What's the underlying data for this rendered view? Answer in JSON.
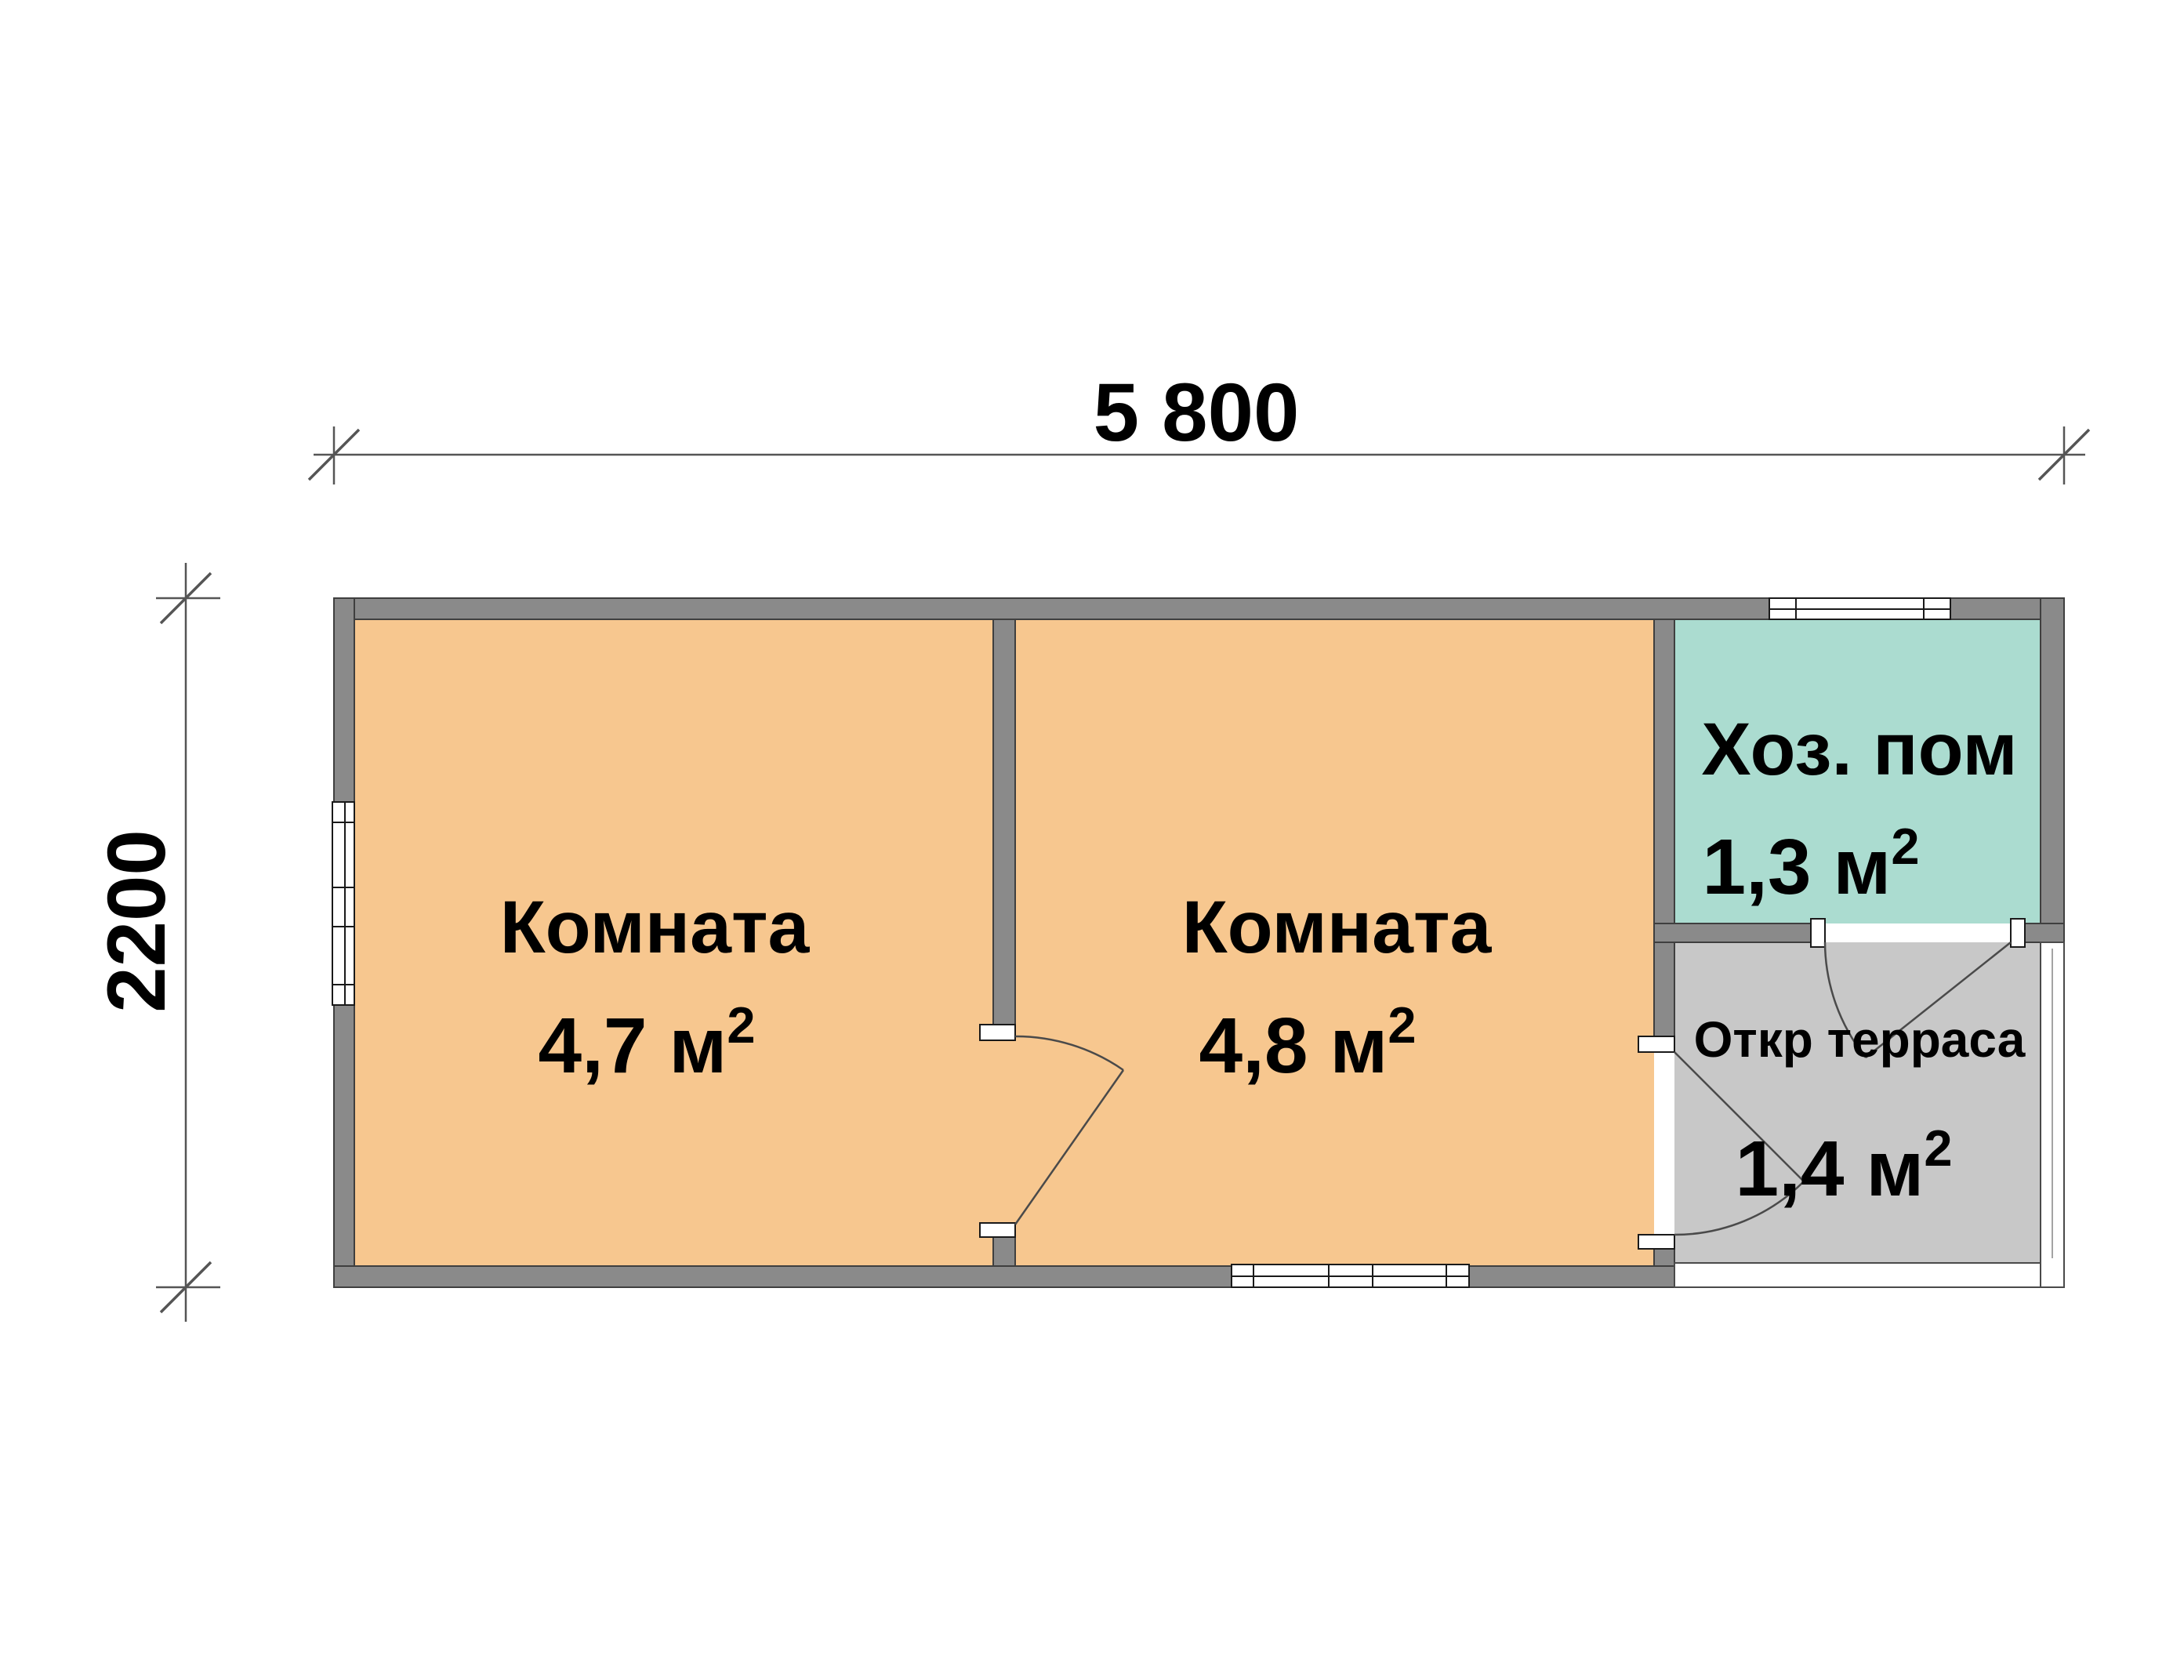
{
  "plan": {
    "title": "floor-plan",
    "dimensions": {
      "width_label": "5 800",
      "height_label": "2200"
    },
    "rooms": [
      {
        "label": "Комната",
        "area": "4,7 м",
        "area_sup": "2"
      },
      {
        "label": "Комната",
        "area": "4,8 м",
        "area_sup": "2"
      },
      {
        "label": "Хоз. пом",
        "area": "1,3 м",
        "area_sup": "2"
      },
      {
        "label": "Откр терраса",
        "area": "1,4 м",
        "area_sup": "2"
      }
    ],
    "colors": {
      "room_fill": "#F7C78F",
      "utility_fill": "#ABDCD0",
      "terrace_fill": "#C8C8C8",
      "wall_fill": "#8A8A8A",
      "background": "#FFFFFF"
    }
  }
}
